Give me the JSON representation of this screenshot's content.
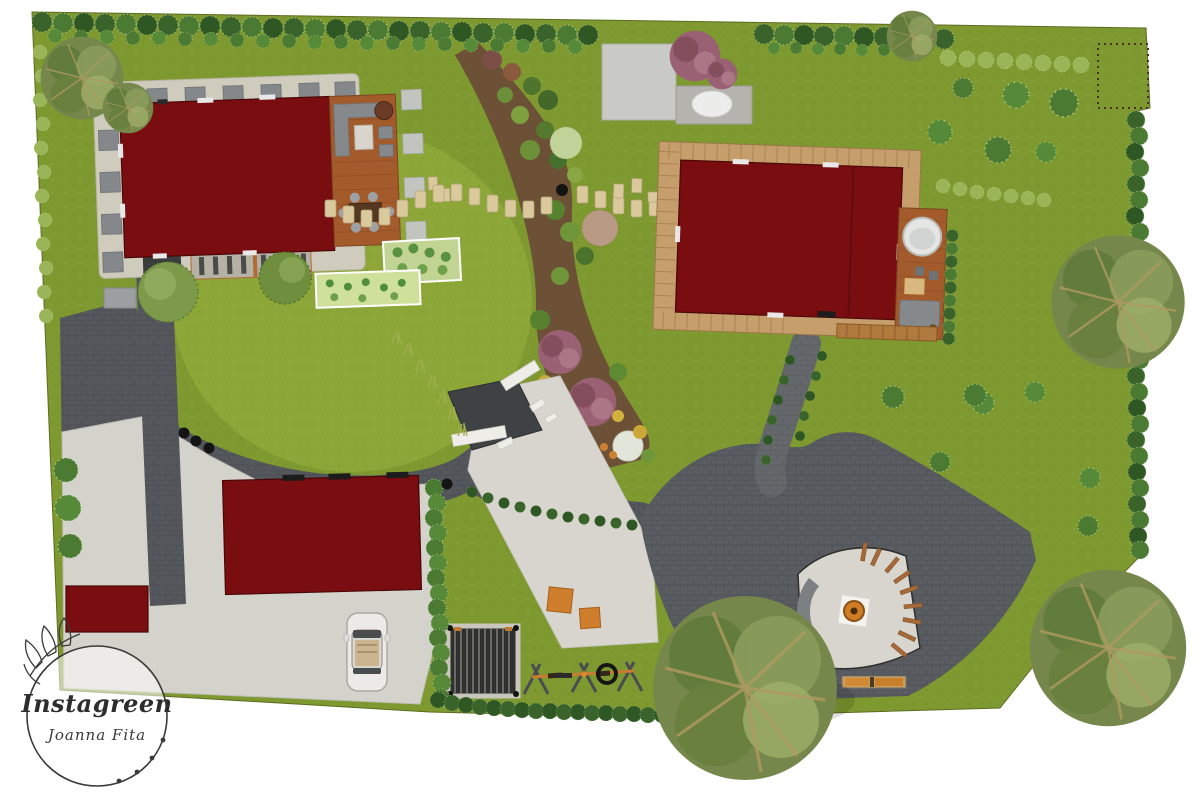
{
  "logo": {
    "brand": "Instagreen",
    "author": "Joanna Fita"
  },
  "palette": {
    "roofRed": "#7A0D10",
    "lawn": "#7E992F",
    "lawnLight": "#8CA637",
    "deckWood": "#A35B2B",
    "plankWood": "#C59E6B",
    "gravel": "#CFCBBD",
    "steppingStone": "#D9C99D",
    "mulch": "#6D5136",
    "paveDark": "#54585C",
    "paveMid": "#64686C",
    "plaza": "#595D61",
    "driveway": "#D4D3CB",
    "patio": "#D8D5CE",
    "hedgeDark": "#39632A",
    "hedgeMid": "#4B7A33",
    "shrubLight": "#9AB558",
    "playOrange": "#CE7E2C",
    "firePit": "#CF7D24",
    "purpleTree": "#9A6073",
    "bedLight": "#CFE09B",
    "carBody": "#ECEAE6",
    "ink": "#3A3A3A"
  }
}
